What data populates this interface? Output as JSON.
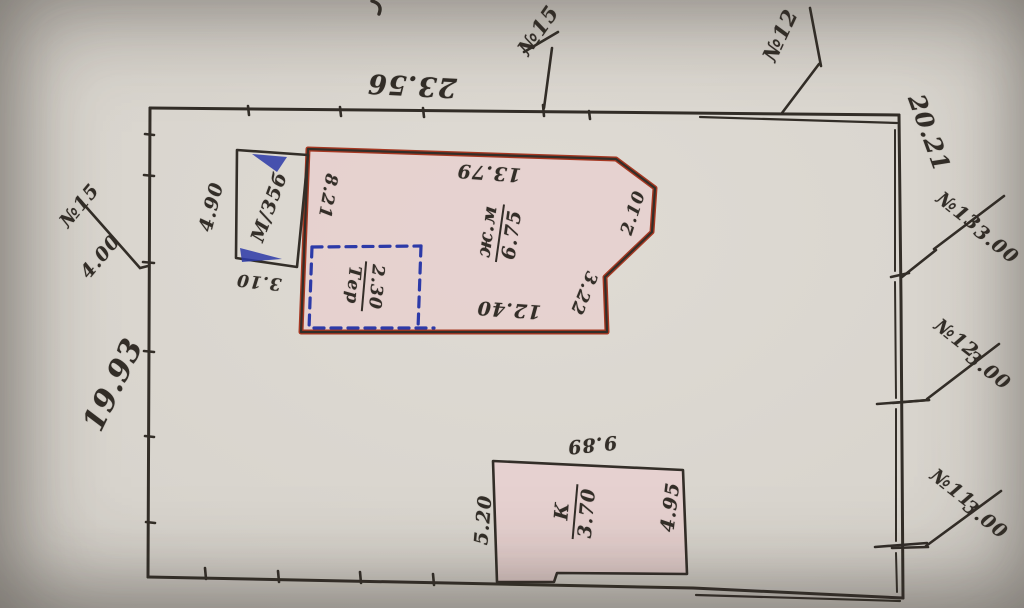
{
  "drawing": {
    "kind": "hand-drawn parcel sketch (photographed, partially upside-down lettering)",
    "parcel": {
      "top_length": "23.56",
      "left_length": "19.93",
      "right_length": "20.21",
      "boundary_points": [
        {
          "id": "№15",
          "distance": "4.00",
          "side": "left"
        },
        {
          "id": "№15",
          "distance": "",
          "side": "top"
        },
        {
          "id": "№12",
          "distance": "",
          "side": "top"
        },
        {
          "id": "№13",
          "distance": "3.00",
          "side": "right"
        },
        {
          "id": "№12",
          "distance": "3.00",
          "side": "right"
        },
        {
          "id": "№11",
          "distance": "3.00",
          "side": "right"
        }
      ]
    },
    "buildings": [
      {
        "name": "main-house",
        "label": "ж.м / 6.75",
        "sides": [
          "8.21",
          "13.79",
          "2.10",
          "3.22",
          "12.40"
        ],
        "fill": "pink",
        "outline": "red"
      },
      {
        "name": "garage",
        "label": "М/35б",
        "sides": [
          "4.90",
          "3.10"
        ],
        "fill": "none",
        "outline": "black"
      },
      {
        "name": "planned-annex",
        "label": "Тер / 2.30",
        "outline": "blue-dashed"
      },
      {
        "name": "k-building",
        "label": "К / 3.70",
        "sides": [
          "9.89",
          "5.20",
          "4.95"
        ],
        "fill": "pink",
        "outline": "black"
      }
    ]
  },
  "colors": {
    "ink": "#332e28",
    "red": "#a63822",
    "blue": "#2c3aa8",
    "pink": "#e8d0cf",
    "paper": "#d6d2cb"
  },
  "labels": [
    {
      "name": "dim-top-23-56",
      "text": "23.56",
      "x": 412,
      "y": 85,
      "rot": 183,
      "fs": 27
    },
    {
      "name": "point-15-top",
      "text": "№15",
      "x": 538,
      "y": 30,
      "rot": -55,
      "fs": 21
    },
    {
      "name": "point-12-top",
      "text": "№12",
      "x": 780,
      "y": 35,
      "rot": -65,
      "fs": 21
    },
    {
      "name": "dim-right-20-21",
      "text": "20.21",
      "x": 929,
      "y": 133,
      "rot": 70,
      "fs": 24
    },
    {
      "name": "point-13-id",
      "text": "№13",
      "x": 958,
      "y": 212,
      "rot": 38,
      "fs": 19
    },
    {
      "name": "point-13-dist",
      "text": "3.00",
      "x": 996,
      "y": 245,
      "rot": 38,
      "fs": 19
    },
    {
      "name": "point-12r-id",
      "text": "№12",
      "x": 956,
      "y": 339,
      "rot": 38,
      "fs": 19
    },
    {
      "name": "point-12r-dist",
      "text": "3.00",
      "x": 988,
      "y": 371,
      "rot": 38,
      "fs": 19
    },
    {
      "name": "point-11-id",
      "text": "№11",
      "x": 952,
      "y": 489,
      "rot": 38,
      "fs": 19
    },
    {
      "name": "point-11-dist",
      "text": "3.00",
      "x": 985,
      "y": 520,
      "rot": 38,
      "fs": 19
    },
    {
      "name": "point-15l-id",
      "text": "№15",
      "x": 80,
      "y": 206,
      "rot": -50,
      "fs": 19
    },
    {
      "name": "point-15l-dist",
      "text": "4.00",
      "x": 101,
      "y": 257,
      "rot": -50,
      "fs": 19
    },
    {
      "name": "dim-left-19-93",
      "text": "19.93",
      "x": 114,
      "y": 385,
      "rot": -64,
      "fs": 30
    },
    {
      "name": "garage-dim-4-90",
      "text": "4.90",
      "x": 212,
      "y": 207,
      "rot": -76,
      "fs": 19
    },
    {
      "name": "garage-label",
      "text": "М/35б",
      "x": 270,
      "y": 207,
      "rot": -70,
      "fs": 19
    },
    {
      "name": "garage-dim-3-10",
      "text": "3.10",
      "x": 259,
      "y": 281,
      "rot": 186,
      "fs": 17
    },
    {
      "name": "house-dim-8-21",
      "text": "8.21",
      "x": 327,
      "y": 196,
      "rot": 100,
      "fs": 17
    },
    {
      "name": "house-dim-13-79",
      "text": "13.79",
      "x": 489,
      "y": 172,
      "rot": 184,
      "fs": 19
    },
    {
      "name": "house-dim-12-40",
      "text": "12.40",
      "x": 509,
      "y": 309,
      "rot": 184,
      "fs": 19
    },
    {
      "name": "house-dim-3-22",
      "text": "3.22",
      "x": 583,
      "y": 293,
      "rot": 112,
      "fs": 17
    },
    {
      "name": "house-dim-2-10",
      "text": "2.10",
      "x": 634,
      "y": 213,
      "rot": -72,
      "fs": 17
    },
    {
      "name": "kbld-dim-9-89",
      "text": "9.89",
      "x": 592,
      "y": 444,
      "rot": 174,
      "fs": 19
    },
    {
      "name": "kbld-dim-5-20",
      "text": "5.20",
      "x": 484,
      "y": 520,
      "rot": -85,
      "fs": 19
    },
    {
      "name": "kbld-dim-4-95",
      "text": "4.95",
      "x": 671,
      "y": 507,
      "rot": -83,
      "fs": 19
    }
  ],
  "fractions": [
    {
      "name": "house-type-label",
      "upper": "ж.м",
      "lower": "6.75",
      "x": 500,
      "y": 233,
      "rot": -82,
      "fs": 19
    },
    {
      "name": "annex-label",
      "upper": "2.30",
      "lower": "Тер",
      "x": 364,
      "y": 286,
      "rot": 95,
      "fs": 17
    },
    {
      "name": "kbld-label",
      "upper": "К",
      "lower": "3.70",
      "x": 575,
      "y": 512,
      "rot": -85,
      "fs": 19
    }
  ]
}
